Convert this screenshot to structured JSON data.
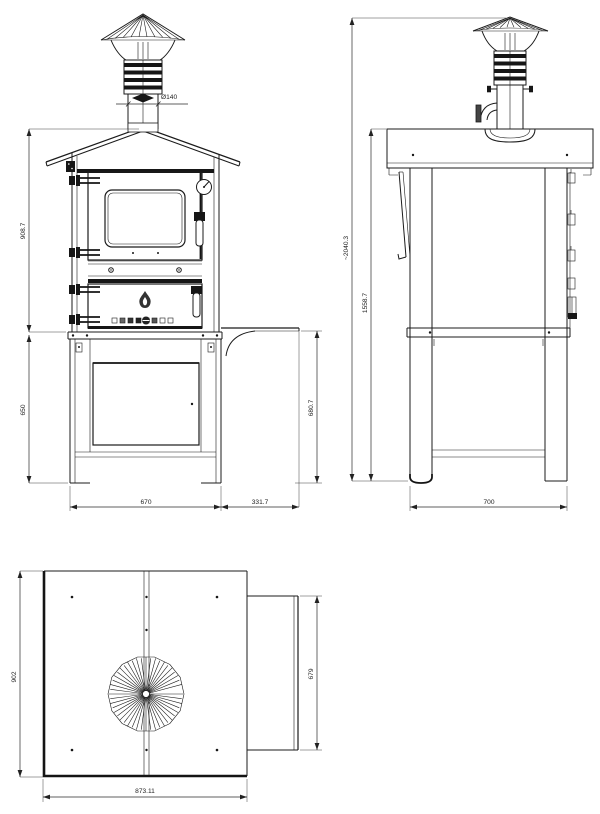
{
  "front_view": {
    "dims": {
      "chimney_diameter": "Ø140",
      "body_height": "908.7",
      "stand_height": "650",
      "shelf_height": "680.7",
      "body_width": "670",
      "shelf_width": "331.7"
    }
  },
  "side_view": {
    "dims": {
      "overall_height": "~2040.3",
      "worktop_height": "1558.7",
      "depth": "700"
    }
  },
  "top_view": {
    "dims": {
      "depth": "902",
      "width": "873.11",
      "shelf_depth": "679"
    }
  }
}
